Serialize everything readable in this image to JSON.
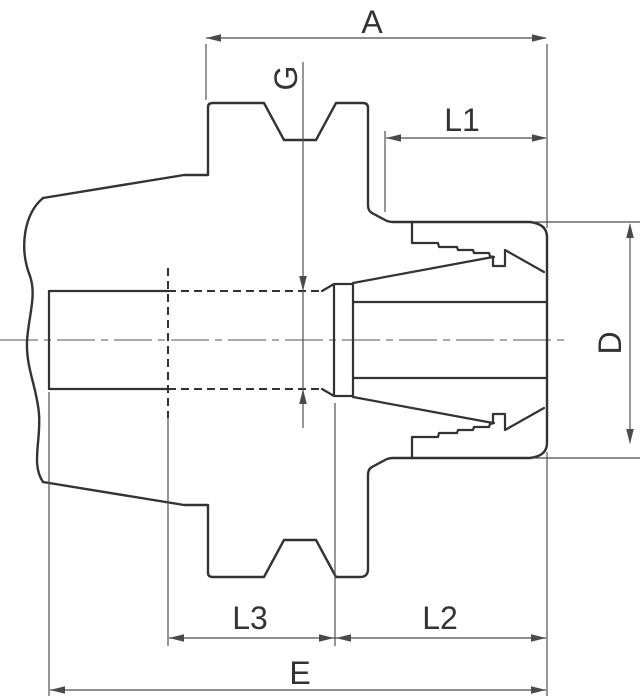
{
  "drawing": {
    "kind": "collet-chuck-cross-section",
    "labels": {
      "a": "A",
      "g": "G",
      "l1": "L1",
      "d": "D",
      "l3": "L3",
      "l2": "L2",
      "e": "E"
    }
  },
  "colors": {
    "background": "#ffffff",
    "outline": "#333333",
    "dimension": "#4a4a4a",
    "centerline": "#9e9e9e",
    "text": "#333333"
  }
}
